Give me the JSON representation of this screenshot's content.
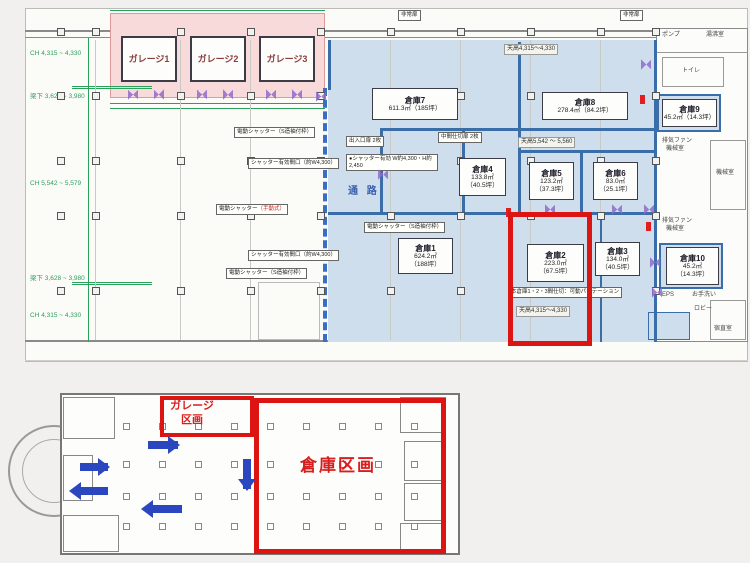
{
  "colors": {
    "blue_zone": "#cfdeec",
    "pink_zone": "#f8dada",
    "highlight_red": "#dd1512",
    "wall_blue": "#3a6ea8",
    "dim_green": "#2ba05a",
    "door_purple": "#8f6cc9",
    "arrow_blue": "#2a47c0",
    "label_red": "#d81f1f"
  },
  "top_plan": {
    "ceiling_labels": [
      "CH 4,315 ~ 4,330",
      "梁下 3,628 ~ 3,980",
      "CH 5,542 ~ 5,579",
      "梁下 3,628 ~ 3,980",
      "CH 4,315 ~ 4,330"
    ],
    "garages": [
      {
        "label": "ガレージ1"
      },
      {
        "label": "ガレージ2"
      },
      {
        "label": "ガレージ3"
      }
    ],
    "warehouses": [
      {
        "name": "倉庫7",
        "area": "611.3㎡",
        "tsubo": "（185坪）"
      },
      {
        "name": "倉庫8",
        "area": "278.4㎡",
        "tsubo": "（84.2坪）"
      },
      {
        "name": "倉庫4",
        "area": "133.8㎡",
        "tsubo": "（40.5坪）"
      },
      {
        "name": "倉庫5",
        "area": "123.2㎡",
        "tsubo": "（37.3坪）"
      },
      {
        "name": "倉庫6",
        "area": "83.0㎡",
        "tsubo": "（25.1坪）"
      },
      {
        "name": "倉庫1",
        "area": "624.2㎡",
        "tsubo": "（188坪）"
      },
      {
        "name": "倉庫2",
        "area": "223.0㎡",
        "tsubo": "（67.5坪）"
      },
      {
        "name": "倉庫3",
        "area": "134.0㎡",
        "tsubo": "（40.5坪）"
      },
      {
        "name": "倉庫9",
        "area": "45.2㎡",
        "tsubo": "（14.3坪）"
      },
      {
        "name": "倉庫10",
        "area": "45.2㎡",
        "tsubo": "（14.3坪）"
      }
    ],
    "corridor_label": "通 路",
    "height_notes": {
      "top": "天高4,315～4,330",
      "mid": "天高5,542 ～ 5,560",
      "bottom": "天高4,315～4,330"
    },
    "callouts": {
      "emergency_door": "非常扉",
      "shutter_frame": "電動シャッター（S造袖付枠）",
      "shutter_width": "シャッター有効間口（約W4,300）",
      "shutter_manual_a": "電動シャッター",
      "shutter_manual_b": "（手動式）",
      "door_pair": "出入口扉 2枚",
      "door_mid": "中間仕切扉 2枚",
      "shutter_spec": "●シャッター有効 W約4,300・H約2,450",
      "partition": "本倉庫1・2・3間仕切：可動パーテーション"
    },
    "rooms": {
      "pump": "ポンプ",
      "hot_water": "湯沸室",
      "toilet": "トイレ",
      "exhaust_fan": "排気ファン",
      "machine": "機械室",
      "eps": "EPS",
      "washroom": "お手洗い",
      "lobby": "ロビー",
      "night_duty": "宿直室"
    }
  },
  "bottom_plan": {
    "garage_zone": "ガレージ区画",
    "warehouse_zone": "倉庫区画"
  }
}
